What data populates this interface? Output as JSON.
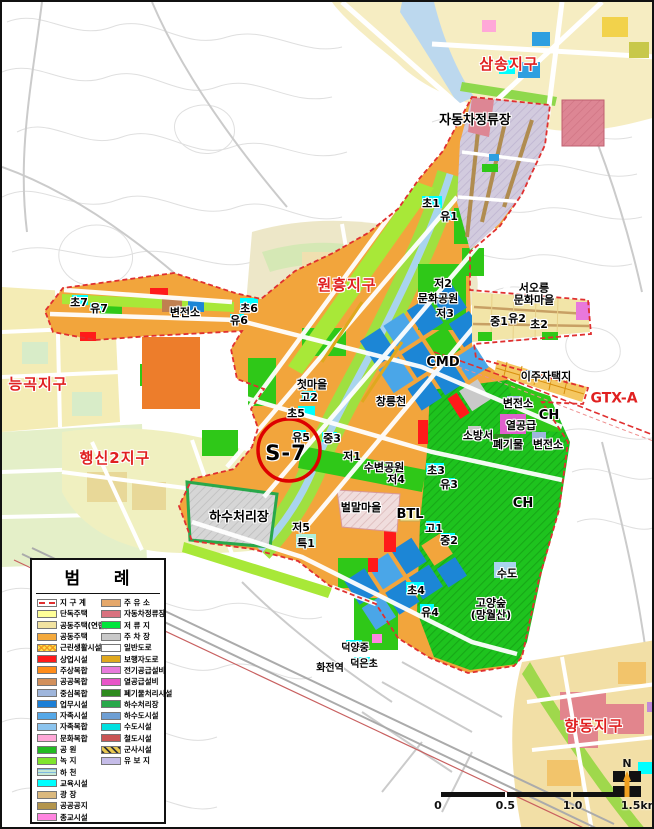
{
  "map": {
    "colors": {
      "district_boundary": "#E03030",
      "residential_orange": "#F2A53C",
      "business_blue": "#1C86D6",
      "park_green": "#2FC818",
      "forest_green": "#1EC31E",
      "education_cyan": "#00FFFF",
      "stream_blue": "#A9D4EE"
    },
    "labels": [
      {
        "t": "삼송지구",
        "x": 507,
        "y": 63,
        "cls": "red15"
      },
      {
        "t": "원흥지구",
        "x": 345,
        "y": 284,
        "cls": "red15"
      },
      {
        "t": "능곡지구",
        "x": 36,
        "y": 383,
        "cls": "red15"
      },
      {
        "t": "행신2지구",
        "x": 113,
        "y": 457,
        "cls": "red15"
      },
      {
        "t": "향동지구",
        "x": 592,
        "y": 725,
        "cls": "red15"
      },
      {
        "t": "GTX-A",
        "x": 612,
        "y": 397,
        "cls": "red13"
      },
      {
        "t": "자동차정류장",
        "x": 473,
        "y": 119,
        "cls": "blk13"
      },
      {
        "t": "CMD",
        "x": 441,
        "y": 361,
        "cls": "blk13"
      },
      {
        "t": "하수처리장",
        "x": 237,
        "y": 516,
        "cls": "blk13"
      },
      {
        "t": "CH",
        "x": 547,
        "y": 414,
        "cls": "blk13"
      },
      {
        "t": "CH",
        "x": 521,
        "y": 502,
        "cls": "blk13"
      },
      {
        "t": "BTL",
        "x": 408,
        "y": 513,
        "cls": "blk13"
      },
      {
        "t": "초1",
        "x": 429,
        "y": 202,
        "cls": ""
      },
      {
        "t": "유1",
        "x": 447,
        "y": 215,
        "cls": ""
      },
      {
        "t": "저2",
        "x": 441,
        "y": 282,
        "cls": ""
      },
      {
        "t": "문화공원",
        "x": 436,
        "y": 297,
        "cls": ""
      },
      {
        "t": "저3",
        "x": 443,
        "y": 312,
        "cls": ""
      },
      {
        "t": "서오릉\n문화마을",
        "x": 532,
        "y": 292,
        "cls": ""
      },
      {
        "t": "중1",
        "x": 497,
        "y": 320,
        "cls": ""
      },
      {
        "t": "유2",
        "x": 515,
        "y": 317,
        "cls": ""
      },
      {
        "t": "초2",
        "x": 537,
        "y": 323,
        "cls": ""
      },
      {
        "t": "변전소",
        "x": 183,
        "y": 311,
        "cls": ""
      },
      {
        "t": "초6",
        "x": 247,
        "y": 307,
        "cls": ""
      },
      {
        "t": "유6",
        "x": 237,
        "y": 319,
        "cls": ""
      },
      {
        "t": "초7",
        "x": 77,
        "y": 301,
        "cls": ""
      },
      {
        "t": "유7",
        "x": 97,
        "y": 307,
        "cls": ""
      },
      {
        "t": "이주자택지",
        "x": 544,
        "y": 375,
        "cls": ""
      },
      {
        "t": "첫마을",
        "x": 310,
        "y": 383,
        "cls": ""
      },
      {
        "t": "창릉천",
        "x": 389,
        "y": 400,
        "cls": ""
      },
      {
        "t": "고2",
        "x": 307,
        "y": 396,
        "cls": ""
      },
      {
        "t": "변전소",
        "x": 516,
        "y": 402,
        "cls": ""
      },
      {
        "t": "열공급",
        "x": 519,
        "y": 424,
        "cls": ""
      },
      {
        "t": "변전소",
        "x": 546,
        "y": 443,
        "cls": ""
      },
      {
        "t": "소방서",
        "x": 476,
        "y": 434,
        "cls": ""
      },
      {
        "t": "폐기물",
        "x": 506,
        "y": 443,
        "cls": ""
      },
      {
        "t": "초5",
        "x": 294,
        "y": 412,
        "cls": ""
      },
      {
        "t": "유5",
        "x": 299,
        "y": 436,
        "cls": ""
      },
      {
        "t": "중3",
        "x": 330,
        "y": 437,
        "cls": ""
      },
      {
        "t": "저1",
        "x": 350,
        "y": 455,
        "cls": ""
      },
      {
        "t": "수변공원",
        "x": 382,
        "y": 466,
        "cls": ""
      },
      {
        "t": "저4",
        "x": 394,
        "y": 478,
        "cls": ""
      },
      {
        "t": "초3",
        "x": 434,
        "y": 469,
        "cls": ""
      },
      {
        "t": "유3",
        "x": 447,
        "y": 483,
        "cls": ""
      },
      {
        "t": "저5",
        "x": 299,
        "y": 526,
        "cls": ""
      },
      {
        "t": "특1",
        "x": 304,
        "y": 542,
        "cls": ""
      },
      {
        "t": "벌말마을",
        "x": 359,
        "y": 506,
        "cls": ""
      },
      {
        "t": "고1",
        "x": 432,
        "y": 527,
        "cls": ""
      },
      {
        "t": "중2",
        "x": 447,
        "y": 539,
        "cls": ""
      },
      {
        "t": "초4",
        "x": 414,
        "y": 589,
        "cls": ""
      },
      {
        "t": "유4",
        "x": 428,
        "y": 611,
        "cls": ""
      },
      {
        "t": "수도",
        "x": 505,
        "y": 572,
        "cls": ""
      },
      {
        "t": "고양숲\n(망월산)",
        "x": 489,
        "y": 607,
        "cls": ""
      },
      {
        "t": "덕양중",
        "x": 353,
        "y": 647,
        "cls": "blk10"
      },
      {
        "t": "화전역",
        "x": 328,
        "y": 667,
        "cls": "blk10"
      },
      {
        "t": "덕은초",
        "x": 362,
        "y": 663,
        "cls": "blk10"
      },
      {
        "t": "S-7",
        "x": 284,
        "y": 451,
        "cls": "s7"
      }
    ]
  },
  "legend": {
    "title": "범    례",
    "left": [
      {
        "label": "지 구 계",
        "color": "#FFFFFF",
        "pattern": "boundary"
      },
      {
        "label": "단독주택",
        "color": "#FFFF99"
      },
      {
        "label": "공동주택(연립)",
        "color": "#F2E3A1"
      },
      {
        "label": "공동주택",
        "color": "#F4A93C"
      },
      {
        "label": "근린생활시설",
        "color": "#FFE14D",
        "pattern": "hatch-nl"
      },
      {
        "label": "상업시설",
        "color": "#FF1A1A"
      },
      {
        "label": "주상복합",
        "color": "#FF8C1A"
      },
      {
        "label": "공공복합",
        "color": "#D2905C"
      },
      {
        "label": "중심복합",
        "color": "#9FB6DC"
      },
      {
        "label": "업무시설",
        "color": "#1C7FD6"
      },
      {
        "label": "자족시설",
        "color": "#55A8E8"
      },
      {
        "label": "자족복합",
        "color": "#8CC4EE"
      },
      {
        "label": "문화복합",
        "color": "#FFA8D8"
      },
      {
        "label": "공 원",
        "color": "#22BB22"
      },
      {
        "label": "녹 지",
        "color": "#7FE52E"
      },
      {
        "label": "하 천",
        "color": "#C6E8D4",
        "pattern": "water"
      },
      {
        "label": "교육시설",
        "color": "#00FFFF"
      },
      {
        "label": "광 장",
        "color": "#DBB97E"
      },
      {
        "label": "공공공지",
        "color": "#B3954D"
      },
      {
        "label": "종교시설",
        "color": "#FF85E0"
      }
    ],
    "right": [
      {
        "label": "주 유 소",
        "color": "#E5A86B"
      },
      {
        "label": "자동차정류장",
        "color": "#D9727F"
      },
      {
        "label": "저 류 지",
        "color": "#00E53C"
      },
      {
        "label": "주 차 장",
        "color": "#C9C9C9"
      },
      {
        "label": "일반도로",
        "color": "#FFFFFF"
      },
      {
        "label": "보행자도로",
        "color": "#E0A81E"
      },
      {
        "label": "전기공급설비",
        "color": "#E87ADC"
      },
      {
        "label": "열공급설비",
        "color": "#E855C8"
      },
      {
        "label": "폐기물처리시설",
        "color": "#2E8B1F"
      },
      {
        "label": "하수처리장",
        "color": "#29A84B"
      },
      {
        "label": "하수도시설",
        "color": "#6E9FD4"
      },
      {
        "label": "수도시설",
        "color": "#00E0E0"
      },
      {
        "label": "철도시설",
        "color": "#C95555"
      },
      {
        "label": "군사시설",
        "color": "#E8C850",
        "pattern": "military"
      },
      {
        "label": "유 보 지",
        "color": "#C5BCE8"
      }
    ]
  },
  "scalebar": {
    "ticks": [
      "0",
      "0.5",
      "1.0",
      "1.5km"
    ]
  },
  "compass": {
    "label": "N"
  }
}
